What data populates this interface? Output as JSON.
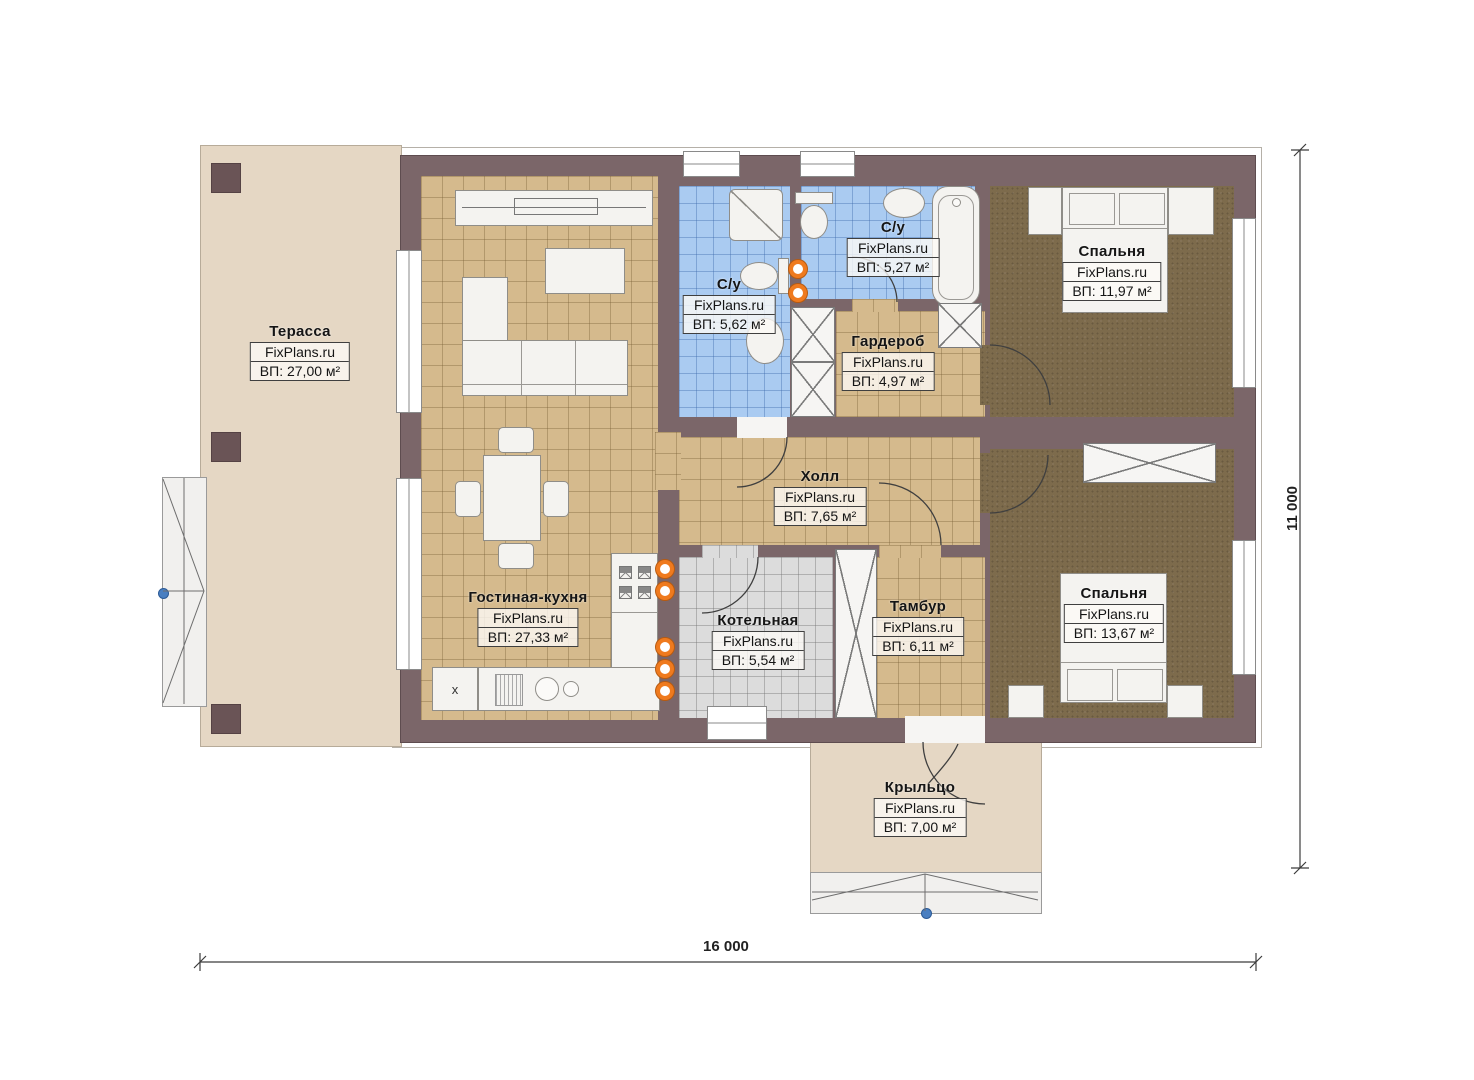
{
  "watermark": "FixPlans.ru",
  "rooms": [
    {
      "id": "terrace",
      "name": "Терасса",
      "area": "ВП: 27,00 м²"
    },
    {
      "id": "bath1",
      "name": "С/у",
      "area": "ВП: 5,62 м²"
    },
    {
      "id": "bath2",
      "name": "С/у",
      "area": "ВП: 5,27 м²"
    },
    {
      "id": "bedroom1",
      "name": "Спальня",
      "area": "ВП: 11,97 м²"
    },
    {
      "id": "wardrobe",
      "name": "Гардероб",
      "area": "ВП: 4,97 м²"
    },
    {
      "id": "hall",
      "name": "Холл",
      "area": "ВП: 7,65 м²"
    },
    {
      "id": "living",
      "name": "Гостиная-кухня",
      "area": "ВП: 27,33 м²"
    },
    {
      "id": "boiler",
      "name": "Котельная",
      "area": "ВП: 5,54 м²"
    },
    {
      "id": "vestibule",
      "name": "Тамбур",
      "area": "ВП: 6,11 м²"
    },
    {
      "id": "bedroom2",
      "name": "Спальня",
      "area": "ВП: 13,67 м²"
    },
    {
      "id": "porch",
      "name": "Крыльцо",
      "area": "ВП: 7,00 м²"
    }
  ],
  "dimensions": {
    "overall_width": "16 000",
    "overall_height": "11 000"
  },
  "markers": {
    "kitchen_appliance": "х"
  },
  "colors": {
    "wall": "#7b6669",
    "floor_tile": "#d5ba8d",
    "bath_tile": "#aacbf1",
    "carpet": "#7d6b4c",
    "boiler_tile": "#dcdcdc",
    "terrace": "#e5d7c4",
    "accent_orange": "#ef7a1e",
    "marker_blue": "#4a7fc1"
  }
}
